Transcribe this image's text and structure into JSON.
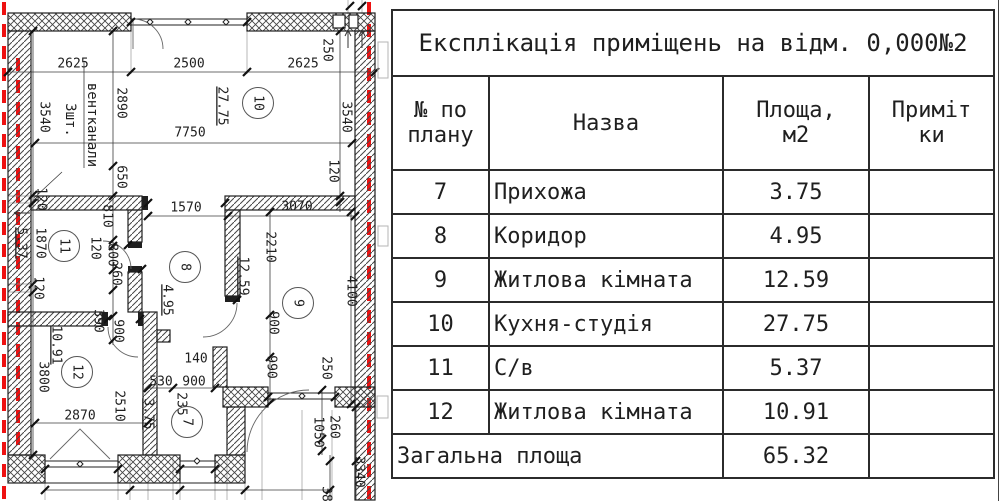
{
  "title": "Експлікація приміщень на відм. 0,000№2",
  "table": {
    "headers": [
      "№ по\nплану",
      "Назва",
      "Площа,\nм2",
      "Приміт\nки"
    ],
    "rows": [
      {
        "num": "7",
        "name": "Прихожа",
        "area": "3.75",
        "note": ""
      },
      {
        "num": "8",
        "name": "Коридор",
        "area": "4.95",
        "note": ""
      },
      {
        "num": "9",
        "name": "Житлова кімната",
        "area": "12.59",
        "note": ""
      },
      {
        "num": "10",
        "name": "Кухня-студія",
        "area": "27.75",
        "note": ""
      },
      {
        "num": "11",
        "name": "С/в",
        "area": "5.37",
        "note": ""
      },
      {
        "num": "12",
        "name": "Житлова кімната",
        "area": "10.91",
        "note": ""
      }
    ],
    "total": {
      "label": "Загальна площа",
      "area": "65.32",
      "note": ""
    }
  },
  "plan": {
    "colors": {
      "insulation-red": "#ee1111",
      "wall-black": "#1f1f1f"
    },
    "labels": [
      {
        "t": "2625",
        "x": 73,
        "y": 64
      },
      {
        "t": "2500",
        "x": 189,
        "y": 64
      },
      {
        "t": "2625",
        "x": 303,
        "y": 64
      },
      {
        "t": "250",
        "x": 327,
        "y": 50,
        "r": 90
      },
      {
        "t": "2890",
        "x": 121,
        "y": 103,
        "r": 90
      },
      {
        "t": "3540",
        "x": 44,
        "y": 117,
        "r": 90
      },
      {
        "t": "вентканали",
        "x": 92,
        "y": 125,
        "r": 90,
        "s": 14
      },
      {
        "t": "3шт.",
        "x": 70,
        "y": 120,
        "r": 90,
        "s": 14
      },
      {
        "t": "27.75",
        "x": 222,
        "y": 106,
        "r": 90,
        "u": true
      },
      {
        "t": "7750",
        "x": 190,
        "y": 133
      },
      {
        "t": "3540",
        "x": 346,
        "y": 117,
        "r": 90
      },
      {
        "t": "650",
        "x": 121,
        "y": 177,
        "r": 90
      },
      {
        "t": "120",
        "x": 333,
        "y": 171,
        "r": 90
      },
      {
        "t": "1570",
        "x": 186,
        "y": 208
      },
      {
        "t": "3070",
        "x": 297,
        "y": 207
      },
      {
        "t": "120",
        "x": 41,
        "y": 199,
        "r": 90
      },
      {
        "t": "810",
        "x": 107,
        "y": 216,
        "r": 90
      },
      {
        "t": "5.37",
        "x": 21,
        "y": 243,
        "r": 90,
        "u": true
      },
      {
        "t": "1870",
        "x": 40,
        "y": 243,
        "r": 90
      },
      {
        "t": "120",
        "x": 95,
        "y": 248,
        "r": 90
      },
      {
        "t": "800",
        "x": 112,
        "y": 255,
        "r": 90
      },
      {
        "t": "260",
        "x": 116,
        "y": 274,
        "r": 90
      },
      {
        "t": "4.95",
        "x": 167,
        "y": 300,
        "r": 90,
        "u": true
      },
      {
        "t": "120",
        "x": 38,
        "y": 288,
        "r": 90
      },
      {
        "t": "390",
        "x": 98,
        "y": 321,
        "r": 90
      },
      {
        "t": "900",
        "x": 118,
        "y": 331,
        "r": 90
      },
      {
        "t": "2210",
        "x": 270,
        "y": 247,
        "r": 90
      },
      {
        "t": "12.59",
        "x": 243,
        "y": 276,
        "r": 90,
        "u": true
      },
      {
        "t": "4100",
        "x": 351,
        "y": 291,
        "r": 90
      },
      {
        "t": "900",
        "x": 273,
        "y": 323,
        "r": 90
      },
      {
        "t": "10.91",
        "x": 56,
        "y": 345,
        "r": 90,
        "u": true
      },
      {
        "t": "3800",
        "x": 43,
        "y": 377,
        "r": 90
      },
      {
        "t": "140",
        "x": 196,
        "y": 359
      },
      {
        "t": "990",
        "x": 271,
        "y": 367,
        "r": 90
      },
      {
        "t": "250",
        "x": 326,
        "y": 368,
        "r": 90
      },
      {
        "t": "530",
        "x": 161,
        "y": 382
      },
      {
        "t": "900",
        "x": 194,
        "y": 382
      },
      {
        "t": "235",
        "x": 181,
        "y": 404,
        "r": 90
      },
      {
        "t": "2510",
        "x": 119,
        "y": 406,
        "r": 90
      },
      {
        "t": "2870",
        "x": 80,
        "y": 416
      },
      {
        "t": "3.75",
        "x": 148,
        "y": 414,
        "r": 90,
        "u": true
      },
      {
        "t": "1050",
        "x": 318,
        "y": 432,
        "r": 90
      },
      {
        "t": "260",
        "x": 334,
        "y": 427,
        "r": 90
      },
      {
        "t": "3340",
        "x": 359,
        "y": 472,
        "r": 90
      },
      {
        "t": "38",
        "x": 326,
        "y": 494,
        "r": 90
      }
    ],
    "rooms": [
      {
        "num": "10",
        "x": 258,
        "y": 103
      },
      {
        "num": "11",
        "x": 64,
        "y": 246
      },
      {
        "num": "8",
        "x": 185,
        "y": 267
      },
      {
        "num": "9",
        "x": 298,
        "y": 303
      },
      {
        "num": "12",
        "x": 77,
        "y": 372
      },
      {
        "num": "7",
        "x": 187,
        "y": 422
      }
    ]
  }
}
